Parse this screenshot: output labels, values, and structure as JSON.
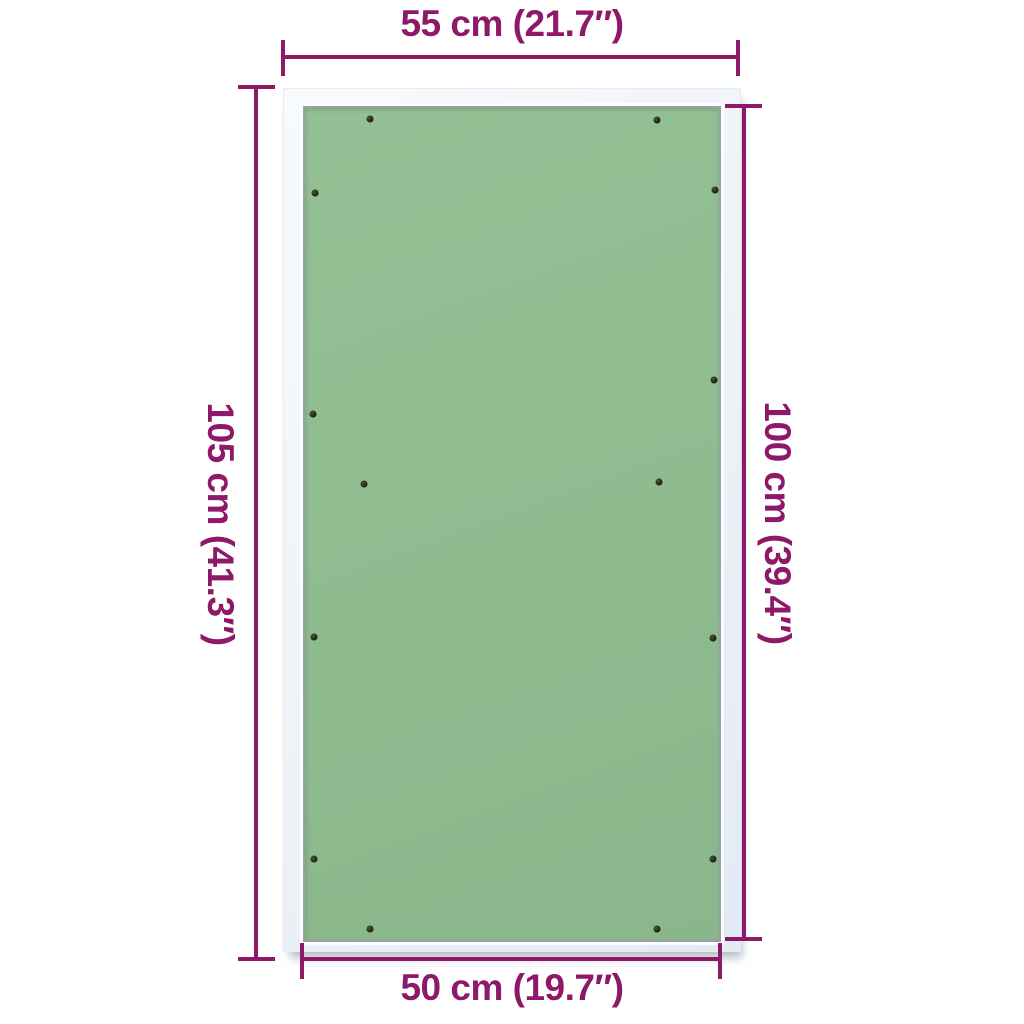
{
  "dimensions": {
    "top": {
      "label": "55 cm (21.7″)"
    },
    "bottom": {
      "label": "50 cm (19.7″)"
    },
    "left": {
      "label": "105 cm (41.3″)"
    },
    "right": {
      "label": "100 cm (39.4″)"
    }
  },
  "colors": {
    "dimension": "#8e1968",
    "panel_green": "#8ebc8f",
    "frame_light": "#edf2f8",
    "frame_border": "#99a1a7",
    "screw_dark": "#171c10",
    "background": "#ffffff"
  },
  "panel": {
    "screw_count": 14,
    "screws": [
      {
        "x": 65,
        "y": 11
      },
      {
        "x": 352,
        "y": 12
      },
      {
        "x": 10,
        "y": 85
      },
      {
        "x": 410,
        "y": 82
      },
      {
        "x": 409,
        "y": 272
      },
      {
        "x": 8,
        "y": 306
      },
      {
        "x": 59,
        "y": 376
      },
      {
        "x": 354,
        "y": 374
      },
      {
        "x": 9,
        "y": 529
      },
      {
        "x": 408,
        "y": 530
      },
      {
        "x": 9,
        "y": 751
      },
      {
        "x": 408,
        "y": 751
      },
      {
        "x": 65,
        "y": 821
      },
      {
        "x": 352,
        "y": 821
      }
    ]
  }
}
